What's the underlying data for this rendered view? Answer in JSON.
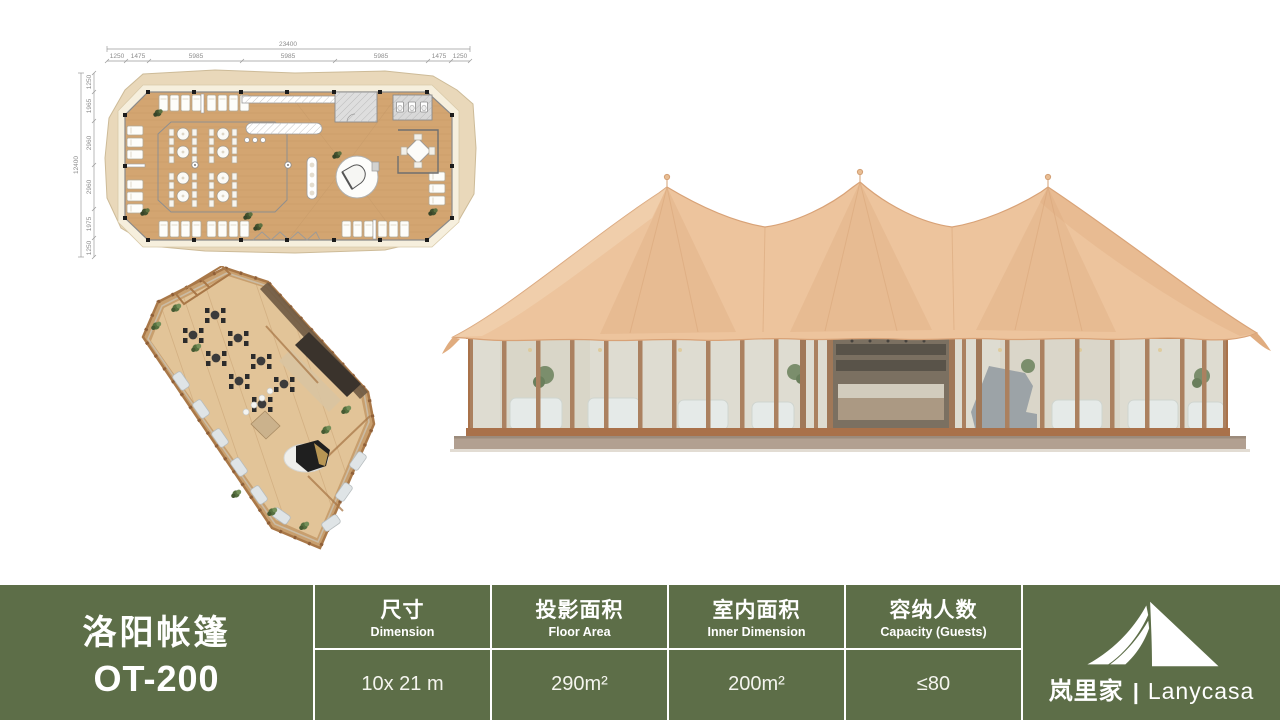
{
  "floor_plan": {
    "width_total": "23400",
    "width_segments": [
      "1250",
      "1475",
      "5985",
      "5985",
      "5985",
      "1475",
      "1250"
    ],
    "height_total": "12400",
    "height_segments": [
      "1250",
      "1965",
      "2960",
      "2960",
      "1975",
      "1250"
    ]
  },
  "spec_bar": {
    "background": "#5d6e48",
    "divider_color": "#ffffff",
    "title": {
      "line1": "洛阳帐篷",
      "line2": "OT-200"
    },
    "columns": [
      {
        "label_cn": "尺寸",
        "label_en": "Dimension",
        "value": "10x 21 m"
      },
      {
        "label_cn": "投影面积",
        "label_en": "Floor Area",
        "value": "290m²"
      },
      {
        "label_cn": "室内面积",
        "label_en": "Inner Dimension",
        "value": "200m²"
      },
      {
        "label_cn": "容纳人数",
        "label_en": "Capacity (Guests)",
        "value": "≤80"
      }
    ],
    "logo": {
      "icon": "tent-logo-icon",
      "brand_cn": "岚里家",
      "separator": "|",
      "brand_en": "Lanycasa"
    }
  },
  "palette": {
    "canvas": "#edc49d",
    "canvas_shade": "#e2b288",
    "canvas_highlight": "#f3d7b6",
    "wood_frame": "#a9724a",
    "plan_wood": "#d3a571",
    "deck_cream": "#f6efdd",
    "bar_green": "#5d6e48"
  }
}
